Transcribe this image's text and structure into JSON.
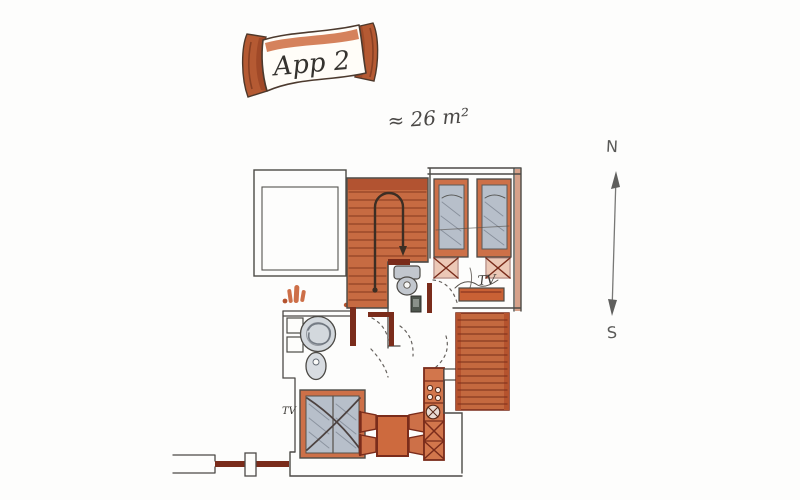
{
  "banner": {
    "title": "App 2"
  },
  "area_label": "≈ 26 m²",
  "compass": {
    "north": "N",
    "south": "S"
  },
  "rooms": {
    "bedroom": {
      "tv_label": "TV"
    },
    "living_room": {
      "tv_label": "TV"
    }
  },
  "palette": {
    "paper": "#fdfdfc",
    "ink": "#4c4a46",
    "wall_red": "#7a2c1b",
    "terracotta": "#cd7048",
    "stair_orange": "#c76b42",
    "ribbon_orange": "#b55a33",
    "mattress_gray_blue": "#b7bfca",
    "compass_gray": "#6e6e6c"
  }
}
